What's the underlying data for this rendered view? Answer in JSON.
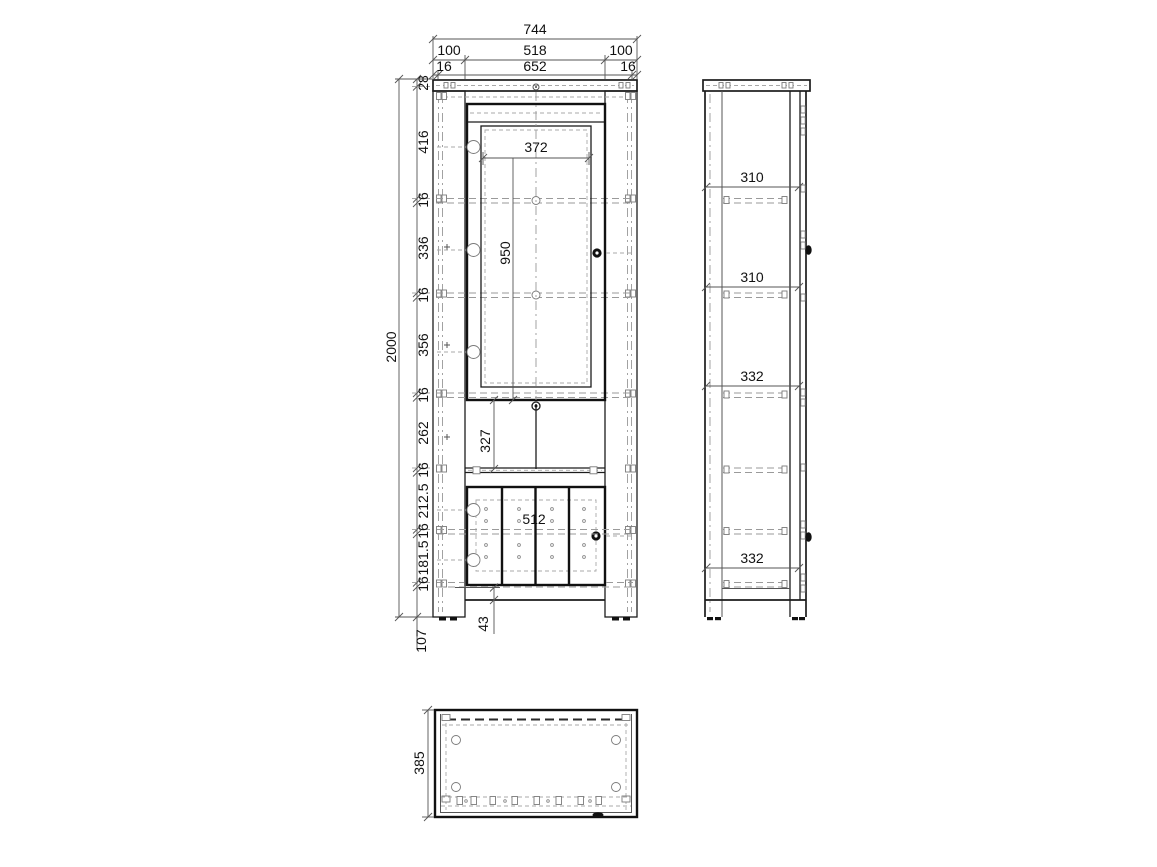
{
  "front_view": {
    "width_total": "744",
    "width_row2": [
      "100",
      "518",
      "100"
    ],
    "width_row3": [
      "16",
      "652",
      "16"
    ],
    "height_total": "2000",
    "left_segments": [
      "28",
      "416",
      "16",
      "336",
      "16",
      "356",
      "16",
      "262",
      "16",
      "212.5",
      "16",
      "181.5",
      "16"
    ],
    "below_floor": "107",
    "glass_width": "372",
    "glass_height": "950",
    "middle_height": "327",
    "lower_door_width": "512",
    "plinth_height": "43"
  },
  "side_view": {
    "shelf_gaps": [
      "310",
      "310",
      "332",
      "332"
    ]
  },
  "top_view": {
    "depth": "385"
  },
  "colors": {
    "line": "#1c1c1c",
    "hidden_line": "#9a9a9a",
    "dimension": "#555555",
    "background": "#ffffff"
  }
}
